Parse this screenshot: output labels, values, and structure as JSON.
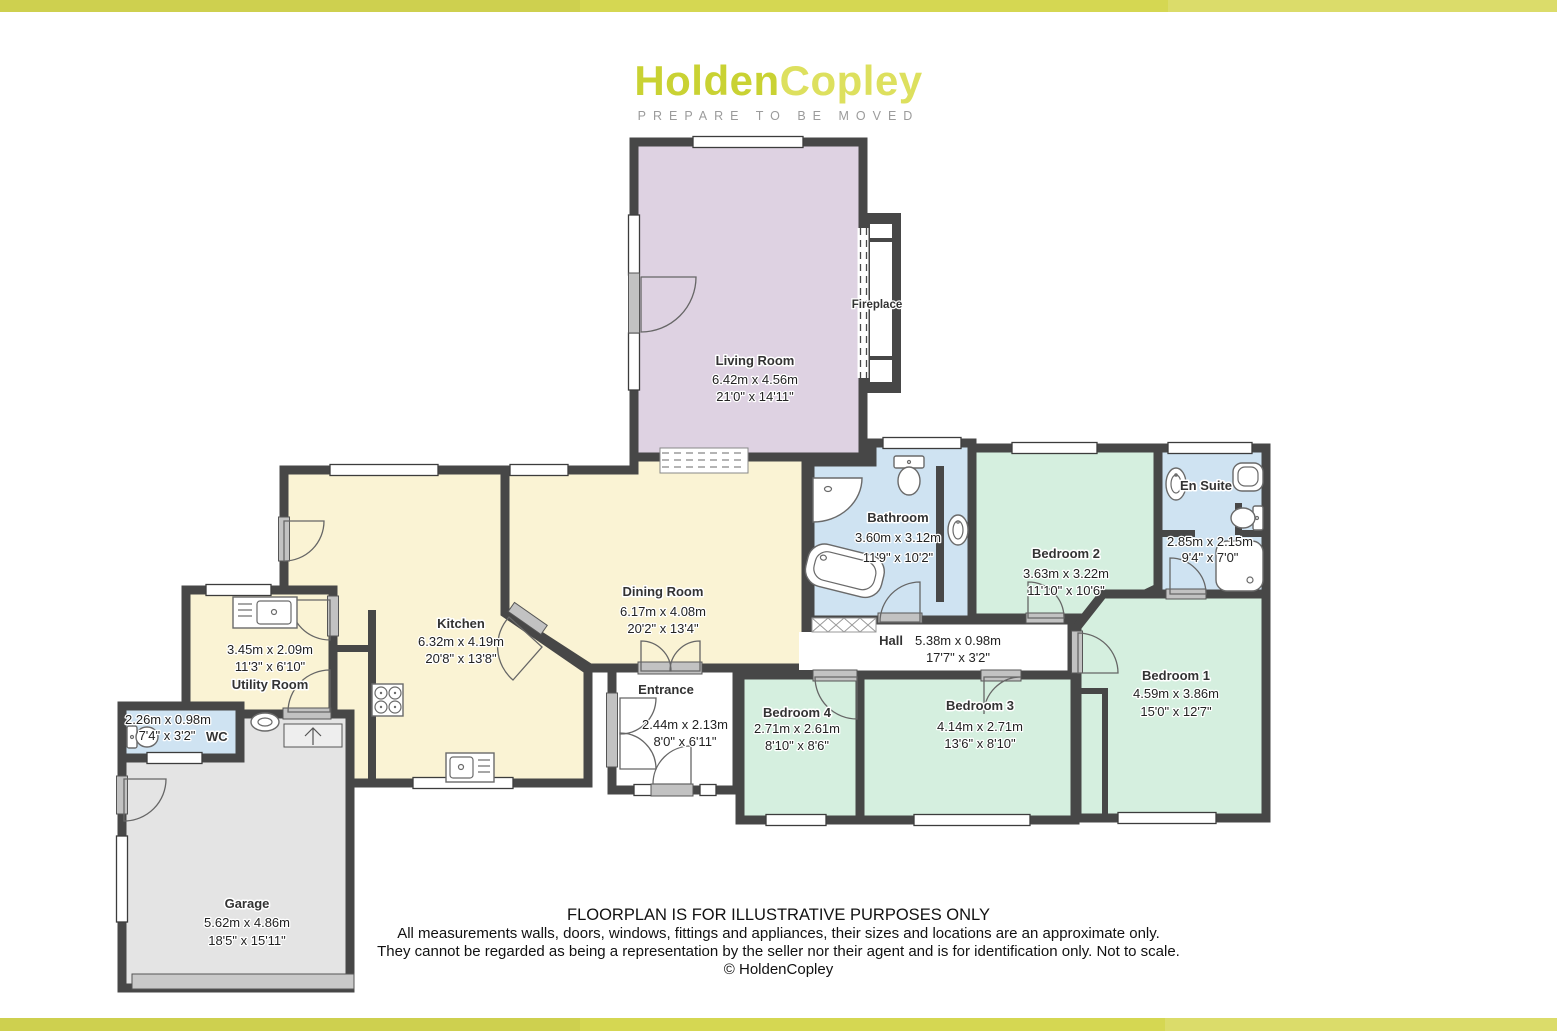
{
  "brand": {
    "name_primary": "Holden",
    "name_secondary": "Copley",
    "tagline": "PREPARE TO BE MOVED"
  },
  "colors": {
    "brand_primary": "#c9d233",
    "brand_secondary": "#dde05e",
    "accent_bar": "#d5d752",
    "wall": "#474747",
    "room_living": "#ded2e2",
    "room_kitchen_dining": "#faf3d4",
    "room_bath": "#cfe3f2",
    "room_bedroom": "#d5efdf",
    "room_garage": "#e4e4e4"
  },
  "rooms": {
    "living_room": {
      "name": "Living Room",
      "metric": "6.42m x 4.56m",
      "imperial": "21'0\" x 14'11\""
    },
    "kitchen": {
      "name": "Kitchen",
      "metric": "6.32m x 4.19m",
      "imperial": "20'8\" x 13'8\""
    },
    "dining_room": {
      "name": "Dining Room",
      "metric": "6.17m x 4.08m",
      "imperial": "20'2\" x 13'4\""
    },
    "bathroom": {
      "name": "Bathroom",
      "metric": "3.60m x 3.12m",
      "imperial": "11'9\" x 10'2\""
    },
    "bedroom_2": {
      "name": "Bedroom 2",
      "metric": "3.63m x 3.22m",
      "imperial": "11'10\" x 10'6\""
    },
    "en_suite": {
      "name": "En Suite",
      "metric": "2.85m x 2.15m",
      "imperial": "9'4\" x 7'0\""
    },
    "bedroom_1": {
      "name": "Bedroom 1",
      "metric": "4.59m x 3.86m",
      "imperial": "15'0\" x 12'7\""
    },
    "hall": {
      "name": "Hall",
      "metric": "5.38m x 0.98m",
      "imperial": "17'7\" x 3'2\""
    },
    "bedroom_4": {
      "name": "Bedroom 4",
      "metric": "2.71m x 2.61m",
      "imperial": "8'10\" x 8'6\""
    },
    "bedroom_3": {
      "name": "Bedroom 3",
      "metric": "4.14m x 2.71m",
      "imperial": "13'6\" x 8'10\""
    },
    "utility_room": {
      "name": "Utility Room",
      "metric": "3.45m x 2.09m",
      "imperial": "11'3\" x 6'10\""
    },
    "wc": {
      "name": "WC",
      "metric": "2.26m x 0.98m",
      "imperial": "7'4\" x 3'2\""
    },
    "entrance": {
      "name": "Entrance",
      "metric": "2.44m x 2.13m",
      "imperial": "8'0\" x 6'11\""
    },
    "garage": {
      "name": "Garage",
      "metric": "5.62m x 4.86m",
      "imperial": "18'5\" x 15'11\""
    }
  },
  "annotations": {
    "fireplace": "Fireplace"
  },
  "disclaimer": {
    "line1": "FLOORPLAN IS FOR ILLUSTRATIVE PURPOSES ONLY",
    "line2": "All measurements walls, doors, windows, fittings and appliances, their sizes and locations are an approximate only.",
    "line3": "They cannot be regarded as being a representation by the seller nor their agent and is for identification only. Not to scale.",
    "line4": "© HoldenCopley"
  }
}
